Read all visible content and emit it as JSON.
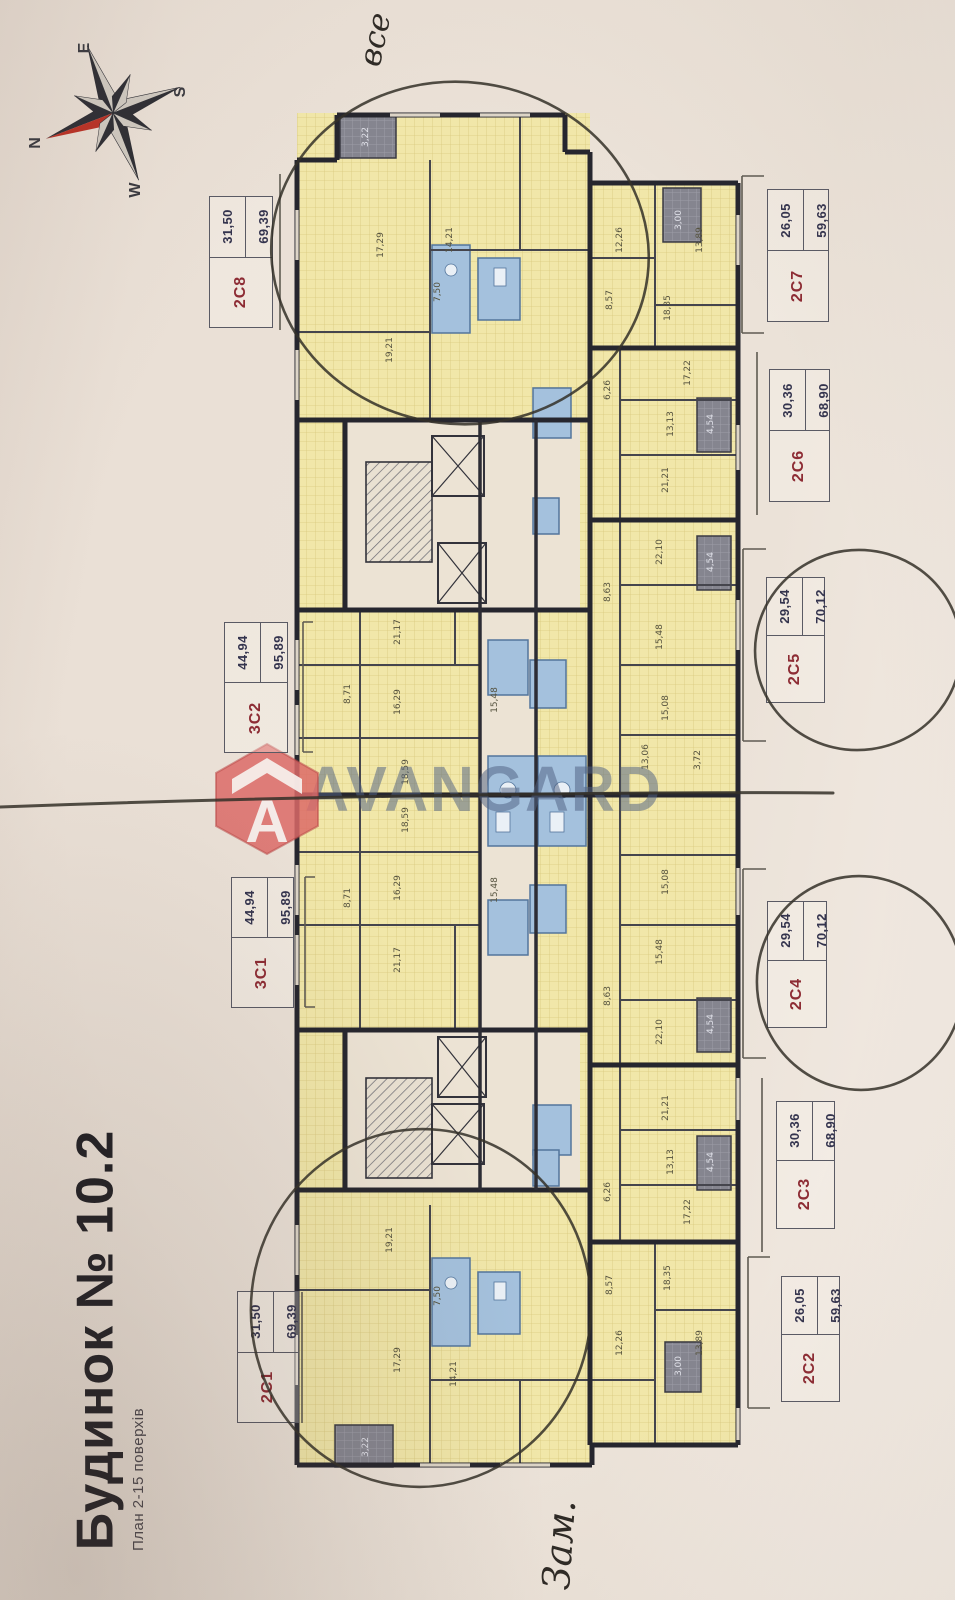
{
  "titleblock": {
    "title": "Будинок № 10.2",
    "subtitle": "План 2-15 поверхів"
  },
  "compass": {
    "n": "N",
    "e": "E",
    "s": "S",
    "w": "W"
  },
  "watermark": {
    "brand": "AVANGARD",
    "logo_letter": "A"
  },
  "annotations": {
    "handwriting_top": "все",
    "handwriting_bottom": "Зам."
  },
  "units": [
    {
      "code": "2С8",
      "area1": "31,50",
      "area2": "69,39"
    },
    {
      "code": "2С7",
      "area1": "26,05",
      "area2": "59,63"
    },
    {
      "code": "2С6",
      "area1": "30,36",
      "area2": "68,90"
    },
    {
      "code": "2С5",
      "area1": "29,54",
      "area2": "70,12"
    },
    {
      "code": "3С2",
      "area1": "44,94",
      "area2": "95,89"
    },
    {
      "code": "3С1",
      "area1": "44,94",
      "area2": "95,89"
    },
    {
      "code": "2С4",
      "area1": "29,54",
      "area2": "70,12"
    },
    {
      "code": "2С3",
      "area1": "30,36",
      "area2": "68,90"
    },
    {
      "code": "2С2",
      "area1": "26,05",
      "area2": "59,63"
    },
    {
      "code": "2С1",
      "area1": "31,50",
      "area2": "69,39"
    }
  ],
  "rooms": [
    {
      "v": "3,22"
    },
    {
      "v": "17,29"
    },
    {
      "v": "14,21"
    },
    {
      "v": "7,50"
    },
    {
      "v": "19,21"
    },
    {
      "v": "12,26"
    },
    {
      "v": "13,89"
    },
    {
      "v": "3,00"
    },
    {
      "v": "8,57"
    },
    {
      "v": "18,35"
    },
    {
      "v": "6,26"
    },
    {
      "v": "17,22"
    },
    {
      "v": "13,13"
    },
    {
      "v": "4,54"
    },
    {
      "v": "21,21"
    },
    {
      "v": "22,10"
    },
    {
      "v": "4,54"
    },
    {
      "v": "8,63"
    },
    {
      "v": "15,48"
    },
    {
      "v": "15,08"
    },
    {
      "v": "13,06"
    },
    {
      "v": "3,72"
    },
    {
      "v": "21,17"
    },
    {
      "v": "8,71"
    },
    {
      "v": "16,29"
    },
    {
      "v": "15,48"
    },
    {
      "v": "18,59"
    },
    {
      "v": "18,59"
    },
    {
      "v": "16,29"
    },
    {
      "v": "15,48"
    },
    {
      "v": "8,71"
    },
    {
      "v": "21,17"
    },
    {
      "v": "15,08"
    },
    {
      "v": "15,48"
    },
    {
      "v": "8,63"
    },
    {
      "v": "22,10"
    },
    {
      "v": "4,54"
    },
    {
      "v": "21,21"
    },
    {
      "v": "13,13"
    },
    {
      "v": "4,54"
    },
    {
      "v": "6,26"
    },
    {
      "v": "17,22"
    },
    {
      "v": "18,35"
    },
    {
      "v": "8,57"
    },
    {
      "v": "12,26"
    },
    {
      "v": "13,89"
    },
    {
      "v": "3,00"
    },
    {
      "v": "19,21"
    },
    {
      "v": "7,50"
    },
    {
      "v": "17,29"
    },
    {
      "v": "14,21"
    },
    {
      "v": "3,22"
    }
  ]
}
